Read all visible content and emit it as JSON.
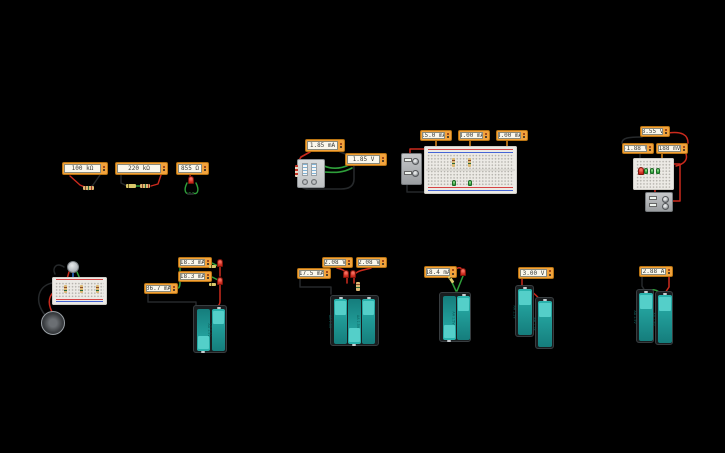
{
  "palette": {
    "background": "#000000",
    "meter_body": "#F2A33C",
    "meter_display": "#FAF7EC",
    "battery_teal": "#1E9E9A",
    "battery_cap": "#54CFC9",
    "holder_black": "#191D1F",
    "breadboard": "#ECEAE5",
    "wire_red": "#CC2A1D",
    "wire_black": "#26292B",
    "wire_green": "#2E9E3A",
    "wire_orange": "#E08A1E",
    "wire_blue": "#2A6FD4",
    "led_red": "#C8271A"
  },
  "battery": {
    "label": "AA 1.5V"
  },
  "meters": {
    "res1": "100 kΩ",
    "res2": "220 kΩ",
    "res3": "855 Ω",
    "dip_current": "1.85 mA",
    "dip_voltage": "1.85 V",
    "bb_total": "15.0 mA",
    "bb_branch1": "8.00 mA",
    "bb_branch2": "8.00 mA",
    "mini_top": "8.55 V",
    "mini_left": "-1.88 V",
    "mini_right": "188 mV",
    "par_led1": "18.3 mA",
    "par_led2": "18.3 mA",
    "par_total": "36.7 mA",
    "trio_v1": "2.08 V",
    "trio_v2": "2.08 V",
    "trio_i": "17.5 mA",
    "pack_i": "18.4 mA",
    "series_v": "3.00 V",
    "loop_i": "2.88 A"
  }
}
